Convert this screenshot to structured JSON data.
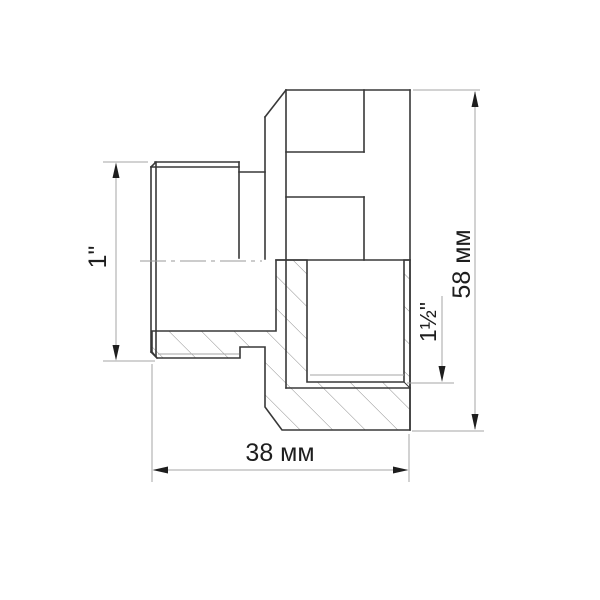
{
  "drawing": {
    "kind": "sectional technical drawing of threaded pipe adapter fitting",
    "dimensions": {
      "male_thread": {
        "label": "1\""
      },
      "female_thread": {
        "label": "1½\""
      },
      "overall_width": {
        "label": "38 мм"
      },
      "overall_height": {
        "label": "58 мм"
      }
    },
    "colors": {
      "background": "#ffffff",
      "outline": "#383838",
      "thin_line": "#a6a6a6",
      "hatch": "#8f8f8f",
      "text": "#1e1e1e"
    }
  }
}
